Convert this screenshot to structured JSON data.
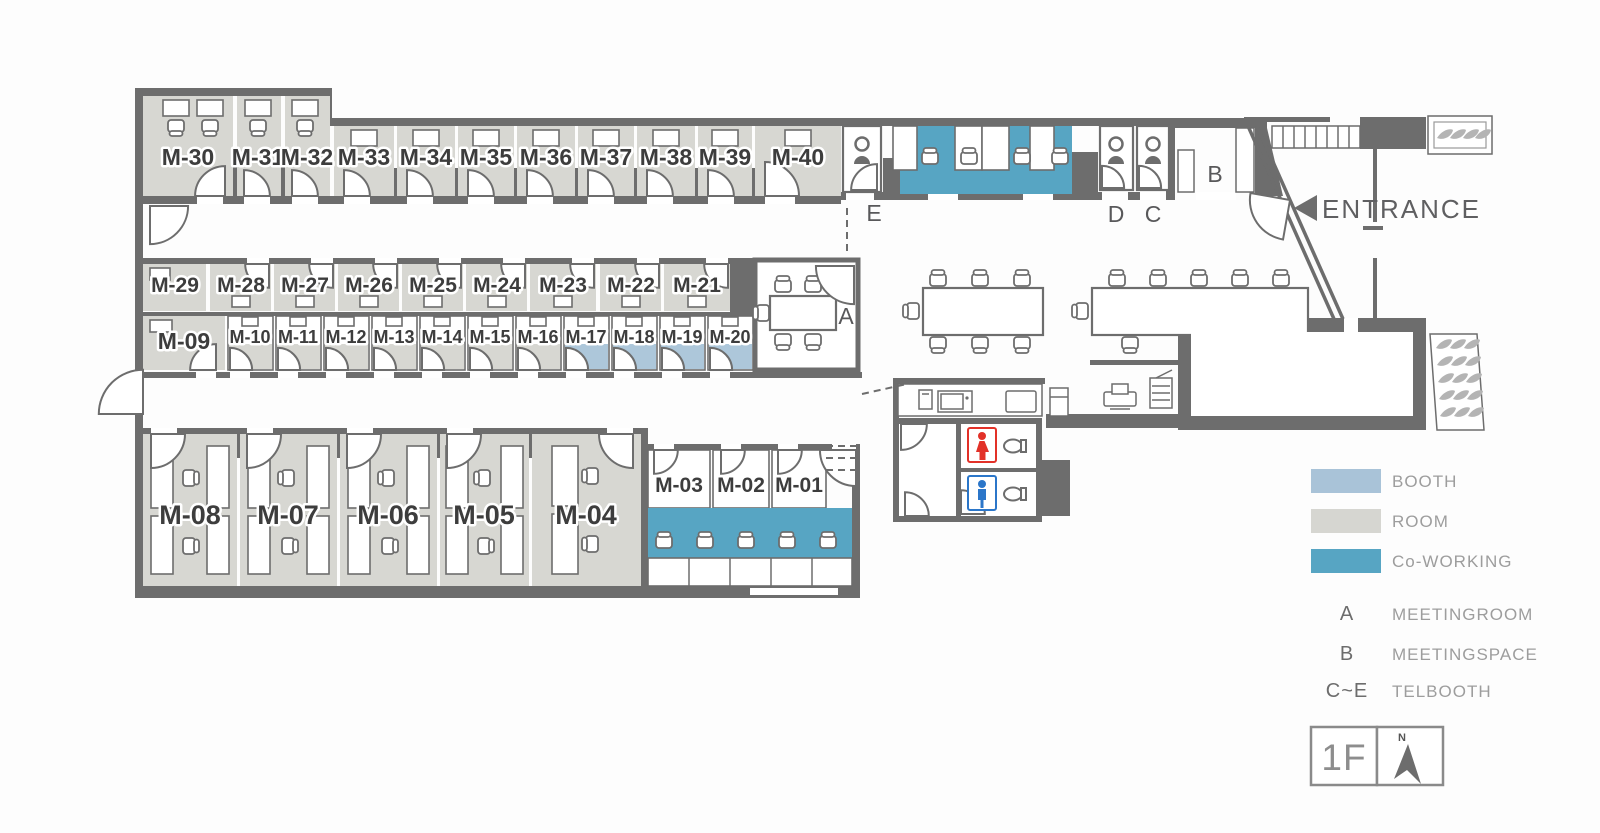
{
  "plan": {
    "rooms_top": [
      "M-30",
      "M-31",
      "M-32",
      "M-33",
      "M-34",
      "M-35",
      "M-36",
      "M-37",
      "M-38",
      "M-39",
      "M-40"
    ],
    "rooms_mid_upper": [
      "M-29",
      "M-28",
      "M-27",
      "M-26",
      "M-25",
      "M-24",
      "M-23",
      "M-22",
      "M-21"
    ],
    "rooms_mid_lower": [
      "M-09",
      "M-10",
      "M-11",
      "M-12",
      "M-13",
      "M-14",
      "M-15",
      "M-16",
      "M-17",
      "M-18",
      "M-19",
      "M-20"
    ],
    "rooms_bottom_large": [
      "M-08",
      "M-07",
      "M-06",
      "M-05",
      "M-04"
    ],
    "rooms_bottom_small": [
      "M-03",
      "M-02",
      "M-01"
    ],
    "zone_labels": {
      "meeting_room": "A",
      "meeting_space": "B",
      "telbooth_c": "C",
      "telbooth_d": "D",
      "telbooth_e": "E"
    },
    "entrance": "ENTRANCE"
  },
  "legend": {
    "swatches": [
      {
        "label": "BOOTH",
        "color": "#a9c3d8"
      },
      {
        "label": "ROOM",
        "color": "#d6d6d1"
      },
      {
        "label": "Co-WORKING",
        "color": "#57a5c3"
      }
    ],
    "keys": [
      {
        "key": "A",
        "label": "MEETINGROOM"
      },
      {
        "key": "B",
        "label": "MEETINGSPACE"
      },
      {
        "key": "C~E",
        "label": "TELBOOTH"
      }
    ]
  },
  "floor": {
    "label": "1F",
    "compass": "N"
  },
  "colors": {
    "wall": "#6d6d6d",
    "room": "#d7d7d2",
    "booth": "#adc7da",
    "coworking": "#57a5c3",
    "women_wc": "#e23128",
    "men_wc": "#2b76c9"
  },
  "icons": {
    "entrance_arrow": "left-triangle",
    "compass_arrow": "north-needle",
    "person": "telbooth-person",
    "toilet": "toilet-bowl",
    "leaf": "plant-leaf",
    "printer": "printer",
    "copier": "copier"
  }
}
